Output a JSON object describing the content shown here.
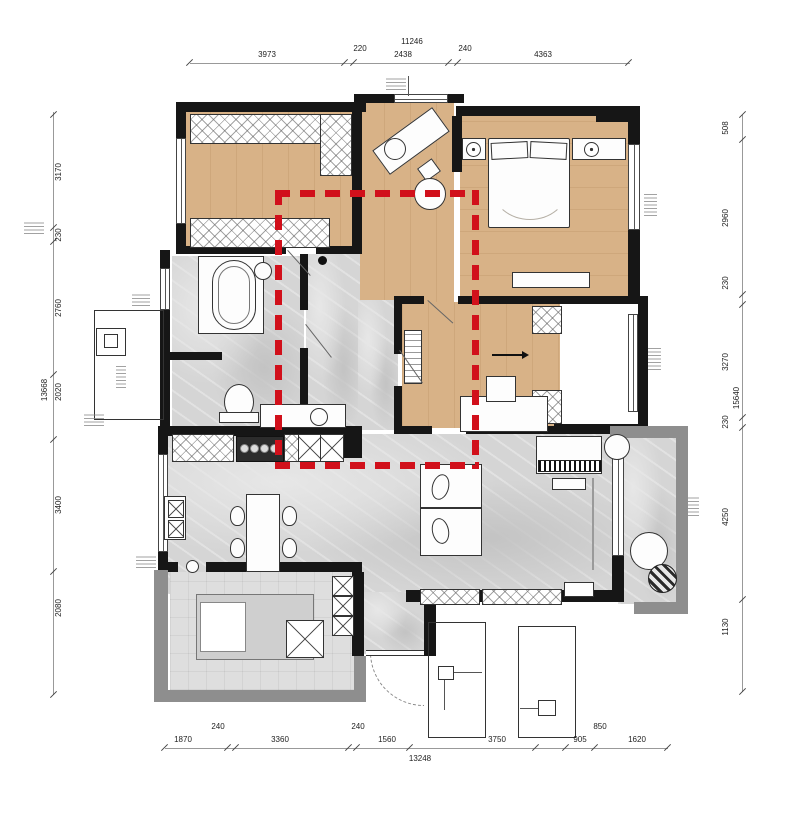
{
  "title": "apartment-floor-plan",
  "colors": {
    "highlight_red": "#d1101b",
    "wood_floor": "#d8b287",
    "tile_floor": "#d5d5d5",
    "wall_black": "#161616",
    "wall_gray": "#8e8e8e"
  },
  "dims": {
    "top": {
      "overall": "11246",
      "s1": "3973",
      "m1": "220",
      "s2": "2438",
      "m2": "240",
      "s3": "4363"
    },
    "left": {
      "overall": "13668",
      "s1": "3170",
      "s2": "230",
      "s3": "2760",
      "s4": "2020",
      "s5": "3400",
      "s6": "2080"
    },
    "right": {
      "overall": "15640",
      "s1": "508",
      "s2": "2960",
      "s3": "230",
      "s4": "3270",
      "s5": "230",
      "s6": "4250",
      "s7": "1130"
    },
    "bottom": {
      "overall": "13248",
      "s1": "1870",
      "m1": "240",
      "s2": "3360",
      "m2": "240",
      "s3": "1560",
      "s4": "3750",
      "s5": "905",
      "m3": "850",
      "s6": "1620"
    }
  }
}
